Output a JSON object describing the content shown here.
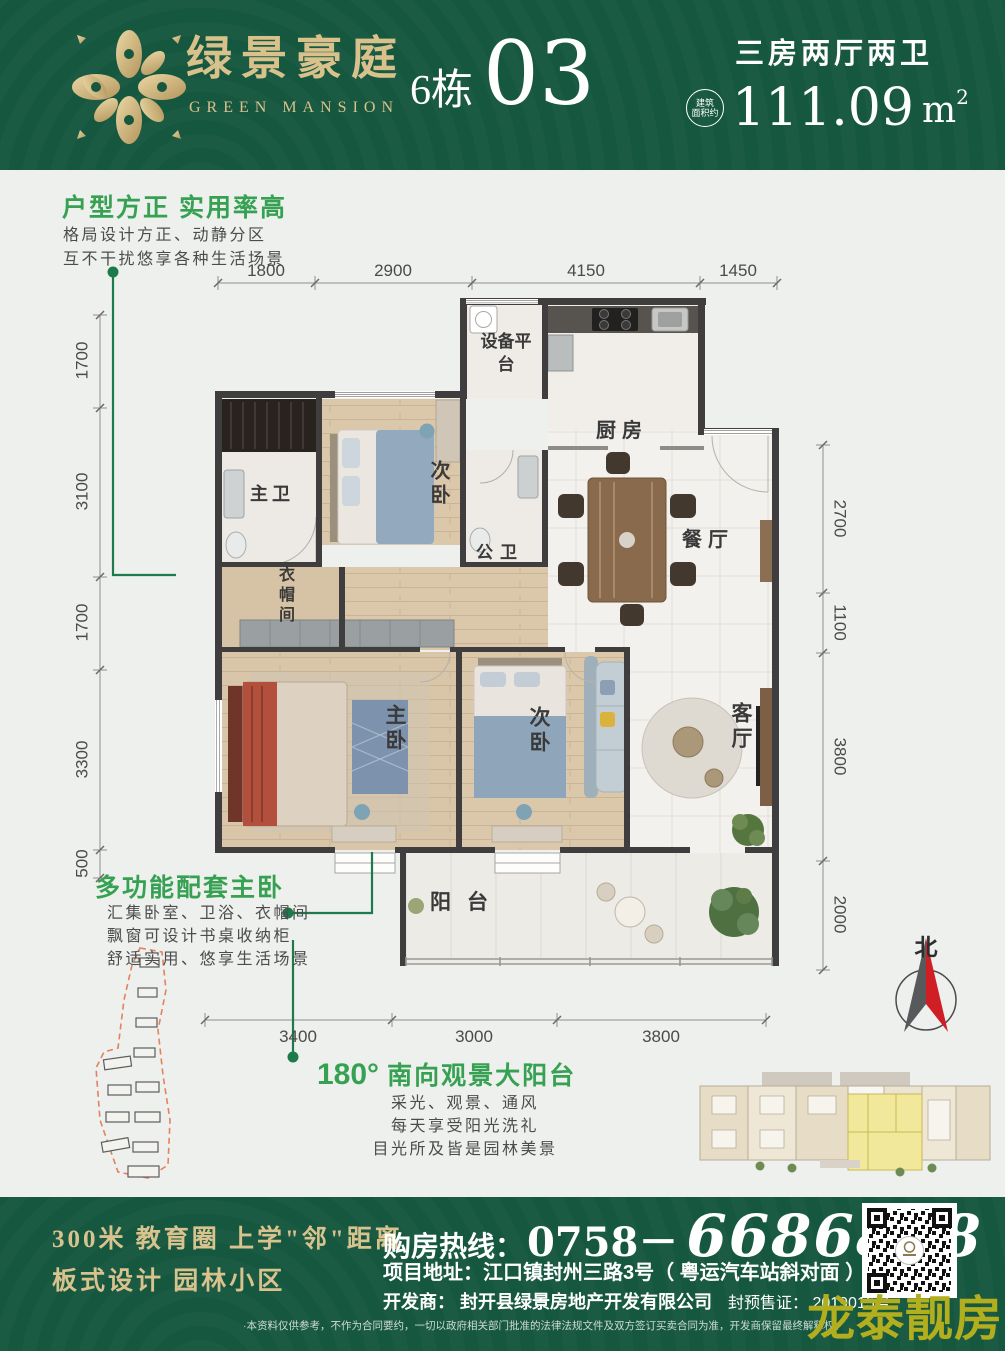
{
  "header": {
    "brand_cn": "绿景豪庭",
    "brand_en": "GREEN MANSION",
    "building": "6栋",
    "unit": "03",
    "spec": "三房两厅两卫",
    "area_badge_top": "建筑",
    "area_badge_bottom": "面积约",
    "area_value": "111.09",
    "area_unit": "m",
    "area_sup": "2"
  },
  "features": {
    "layout": {
      "title": "户型方正 实用率高",
      "line1": "格局设计方正、动静分区",
      "line2": "互不干扰悠享各种生活场景"
    },
    "master": {
      "title": "多功能配套主卧",
      "line1": "汇集卧室、卫浴、衣帽间",
      "line2": "飘窗可设计书桌收纳柜",
      "line3": "舒适实用、悠享生活场景"
    },
    "balcony": {
      "degree": "180°",
      "title": "南向观景大阳台",
      "line1": "采光、观景、通风",
      "line2": "每天享受阳光洗礼",
      "line3": "目光所及皆是园林美景"
    }
  },
  "floorplan": {
    "rooms": {
      "equipment": "设备平台",
      "kitchen": "厨房",
      "dining": "餐厅",
      "master_bath": "主卫",
      "bedroom_top": "次卧",
      "public_bath": "公卫",
      "cloakroom": "衣帽间",
      "master_bedroom": "主卧",
      "bedroom_bottom": "次卧",
      "living": "客厅",
      "balcony": "阳台"
    },
    "dims": {
      "top": [
        "1800",
        "2900",
        "4150",
        "1450"
      ],
      "left": [
        "1700",
        "3100",
        "1700",
        "3300",
        "500"
      ],
      "right": [
        "2700",
        "1100",
        "3800",
        "2000"
      ],
      "bottom": [
        "3400",
        "3000",
        "3800"
      ]
    },
    "compass": "北"
  },
  "footer": {
    "slogan1": "300米 教育圈  上学\"邻\"距离",
    "slogan2": "板式设计   园林小区",
    "hotline_label": "购房热线：",
    "phone_prefix": "0758－",
    "phone_number": "6686888",
    "address": "项目地址：江口镇封州三路3号（ 粤运汽车站斜对面 ）",
    "developer": "开发商： 封开县绿景房地产开发有限公司",
    "license": "封预售证： 2019015号",
    "disclaimer": "·本资料仅供参考，不作为合同要约，一切以政府相关部门批准的法律法规文件及双方签订买卖合同为准，开发商保留最终解释权。",
    "watermark": "龙泰靓房"
  }
}
